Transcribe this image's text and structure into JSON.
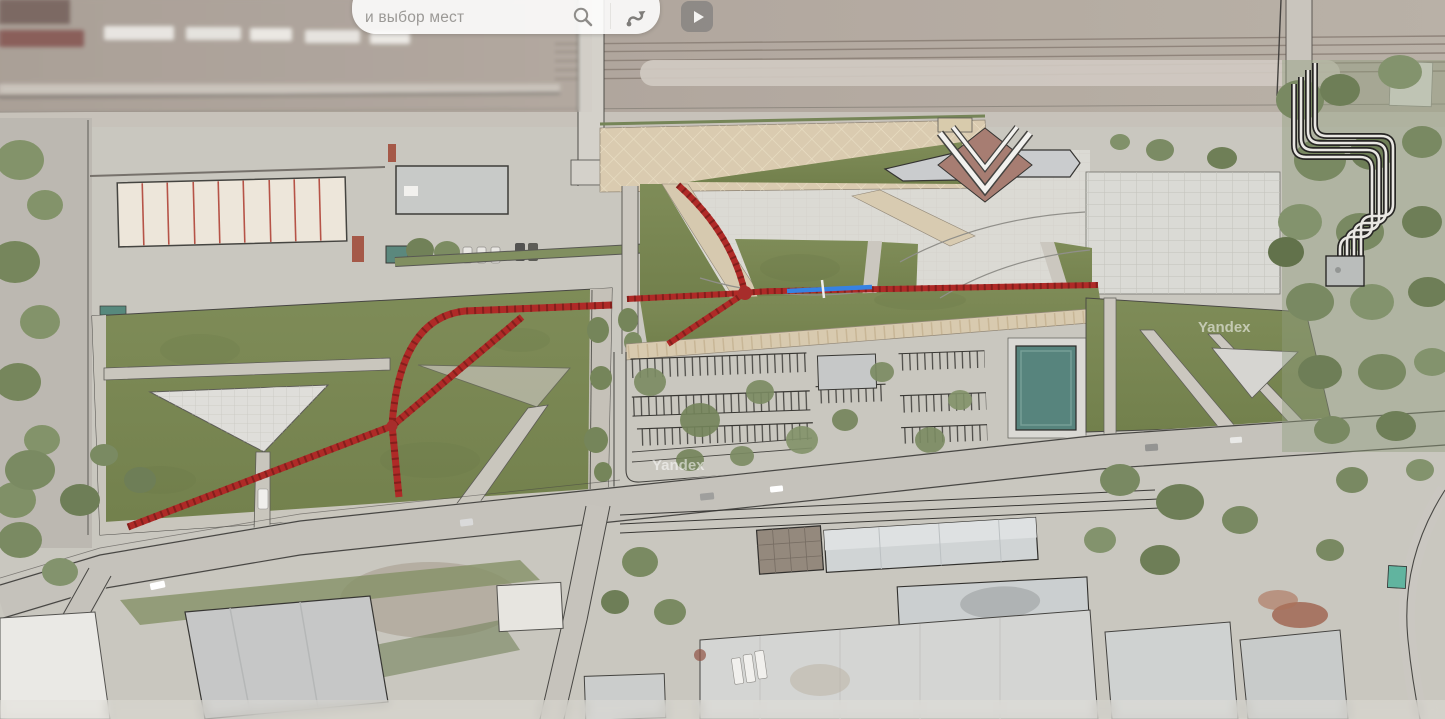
{
  "ui": {
    "search_bar": {
      "visible_text": "и выбор мест",
      "search_icon": "magnifier",
      "routes_icon": "route-curve-with-arrow-and-dot",
      "background": "#ffffff"
    },
    "play_button": {
      "icon": "play-triangle",
      "background": "#868481"
    },
    "watermark": {
      "text": "Yandex"
    }
  },
  "map": {
    "type": "aerial-satellite-with-park-masterplan-overlay",
    "palette": {
      "lawn": "#74824c",
      "red_path": "#ab1f1c",
      "blue_route_segment": "#2c7ce2",
      "esplanade_tiles": "#d8c9ac",
      "plaza": "#dad8d2",
      "asphalt": "#c4c1ba",
      "railway_band": "#a89c93",
      "pool_teal": "#4f7e76",
      "roof_gray": "#ced2d3",
      "warehouse_roof": "#ede5d8",
      "warehouse_seams": "#b34a3e",
      "tree_green": "#72835a",
      "station_roof_center": "#a3766b"
    },
    "features": [
      "railway-yard",
      "pedestrian-bridge",
      "tiled-esplanade",
      "green-esplanade-triangle",
      "station-building-chevron-roof",
      "left-park-lawn",
      "triangular-plaza",
      "red-jogging-paths",
      "blue-route-segment",
      "central-park-lawn",
      "tiled-walkway",
      "parking-rows",
      "pool",
      "right-plaza",
      "heat-pipeline",
      "main-road",
      "industrial-warehouse",
      "south-industrial-buildings"
    ]
  }
}
